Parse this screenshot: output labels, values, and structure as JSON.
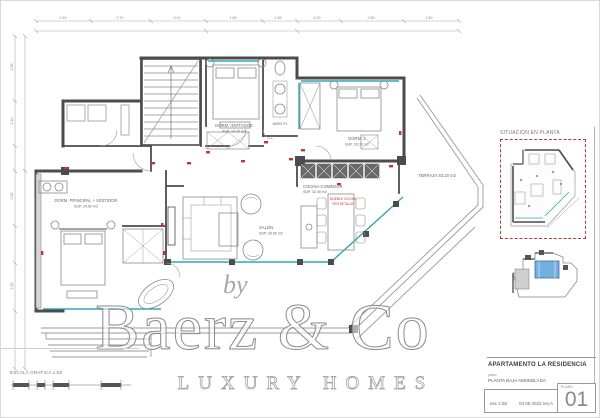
{
  "colors": {
    "wall": "#4c4c4c",
    "furniture_line": "#8a8a8a",
    "glazing": "#2fa8b5",
    "outlet_red": "#c23434",
    "keyplan_frame_red": "#c23434",
    "keyplan_highlight_blue": "#74b0df",
    "watermark_gray": "#9a9a9a"
  },
  "watermark": {
    "by": "by",
    "brand": "Baerz & Co",
    "tagline": "LUXURY HOMES"
  },
  "scalebar": {
    "label": "ESCALA GRAFICA 1:50"
  },
  "titleblock": {
    "project": "APARTAMENTO LA RESIDENCIA",
    "doc_label": "plano",
    "doc_name": "PLANTA BAJA AMUEBLADA",
    "scale": "esc 1:50",
    "reference": "04.05.2022 rev.A",
    "sheet_label": "PLANO",
    "sheet_number": "01"
  },
  "keyplans": {
    "plan1_label": "SITUACION EN PLANTA"
  },
  "plan": {
    "labels": {
      "bedroom1": [
        "DORM. INVITADOS",
        "SUP. 14.20 m2"
      ],
      "bath1": [
        "BAÑO P1"
      ],
      "bedroom2": [
        "DORM. 2",
        "SUP. 16.30 m2"
      ],
      "kitchen": [
        "COCINA-COMEDOR",
        "SUP. 32.40 m2"
      ],
      "kitchen_note": [
        "MUEBLE COCINA",
        "VER DETALLE"
      ],
      "living": [
        "SALON",
        "SUP. 28.50 m2"
      ],
      "master": [
        "DORM. PRINCIPAL + VESTIDOR",
        "SUP. 24.60 m2"
      ],
      "terrace": [
        "TERRAZA 83.20 m2"
      ]
    },
    "dims": {
      "top": [
        "2.45",
        "2.70",
        "3.10",
        "1.85",
        "1.55",
        "2.00",
        "2.85",
        "2.60"
      ],
      "left": [
        "1.85",
        "2.10",
        "3.95",
        "2.45"
      ]
    }
  }
}
